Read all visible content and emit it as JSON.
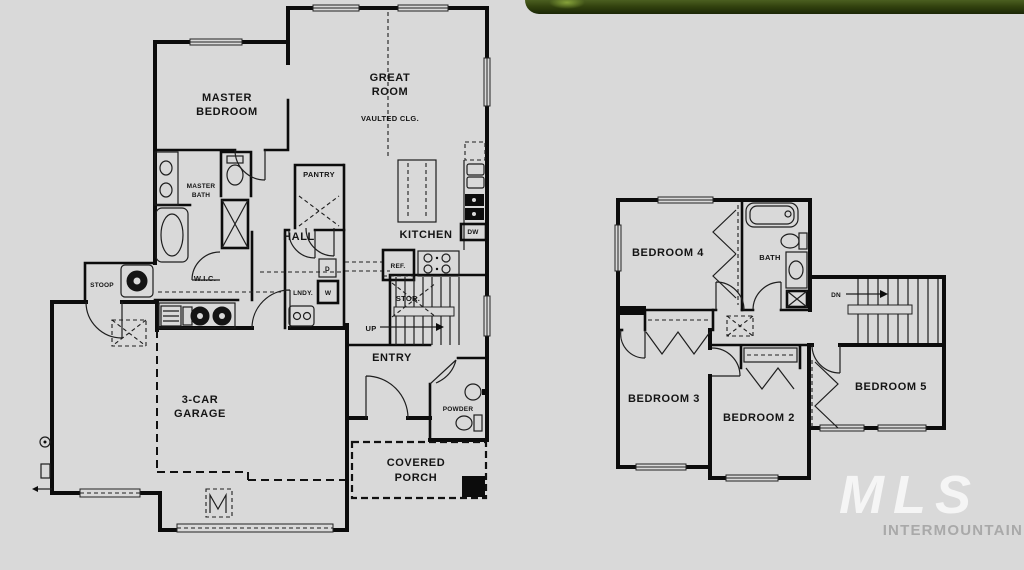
{
  "floor1": {
    "labels": {
      "master_l1": "MASTER",
      "master_l2": "BEDROOM",
      "great_l1": "GREAT",
      "great_l2": "ROOM",
      "great_note": "VAULTED CLG.",
      "mbath_l1": "MASTER",
      "mbath_l2": "BATH",
      "pantry": "PANTRY",
      "hall": "HALL",
      "kitchen": "KITCHEN",
      "wic": "W.I.C.",
      "laundry": "LNDY.",
      "dryer": "D",
      "washer": "W",
      "ref": "REF.",
      "dw": "DW",
      "stor": "STOR.",
      "up": "UP",
      "entry": "ENTRY",
      "powder": "POWDER",
      "stoop": "STOOP",
      "garage_l1": "3-CAR",
      "garage_l2": "GARAGE",
      "porch_l1": "COVERED",
      "porch_l2": "PORCH"
    }
  },
  "floor2": {
    "labels": {
      "bedroom4": "BEDROOM 4",
      "bath": "BATH",
      "dn": "DN",
      "bedroom3": "BEDROOM 3",
      "bedroom2": "BEDROOM 2",
      "bedroom5": "BEDROOM 5"
    }
  },
  "watermark": {
    "brand": "MLS",
    "sub": "INTERMOUNTAIN"
  },
  "colors": {
    "background": "#d9d9d9",
    "line": "#0c0c0c",
    "banner_dark": "#1a2606",
    "banner_light": "#4b5f20",
    "watermark_brand": "rgba(255,255,255,0.72)",
    "watermark_sub": "#a9a9a9"
  }
}
